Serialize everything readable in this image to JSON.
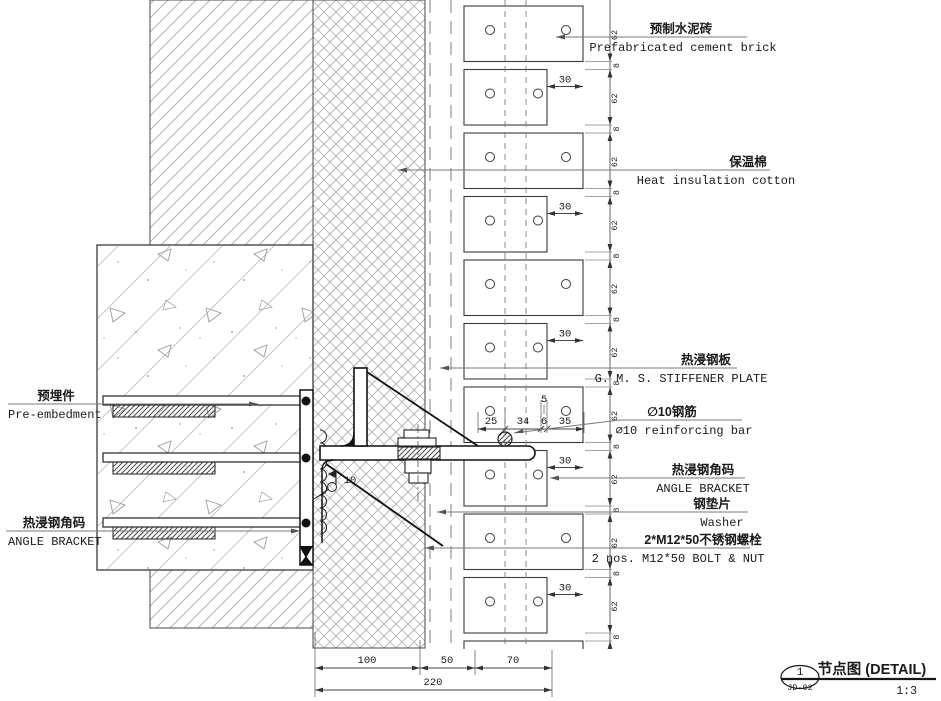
{
  "drawing": {
    "labels_right": [
      {
        "cn": "预制水泥砖",
        "en": "Prefabricated cement brick"
      },
      {
        "cn": "保温棉",
        "en": "Heat insulation cotton"
      },
      {
        "cn": "热浸钢板",
        "en": "G. M. S. STIFFENER PLATE"
      },
      {
        "cn": "∅10钢筋",
        "en": "∅10 reinforcing bar"
      },
      {
        "cn": "热浸钢角码",
        "en": "ANGLE BRACKET"
      },
      {
        "cn": "钢垫片",
        "en": "Washer"
      },
      {
        "cn": "2*M12*50不锈钢螺栓",
        "en": "2 nos. M12*50 BOLT & NUT"
      }
    ],
    "labels_left": [
      {
        "cn": "预埋件",
        "en": "Pre-embedment"
      },
      {
        "cn": "热浸钢角码",
        "en": "ANGLE BRACKET"
      }
    ],
    "dims": {
      "top": [
        "25",
        "34",
        "6",
        "35"
      ],
      "gap": "5",
      "stagger": "30",
      "course": "62",
      "joint": "8",
      "weld": "10",
      "bottom": [
        "100",
        "50",
        "70"
      ],
      "total": "220"
    },
    "title_block": {
      "num": "1",
      "ref": "JD-02",
      "title": "节点图 (DETAIL)",
      "scale": "1:3"
    }
  }
}
